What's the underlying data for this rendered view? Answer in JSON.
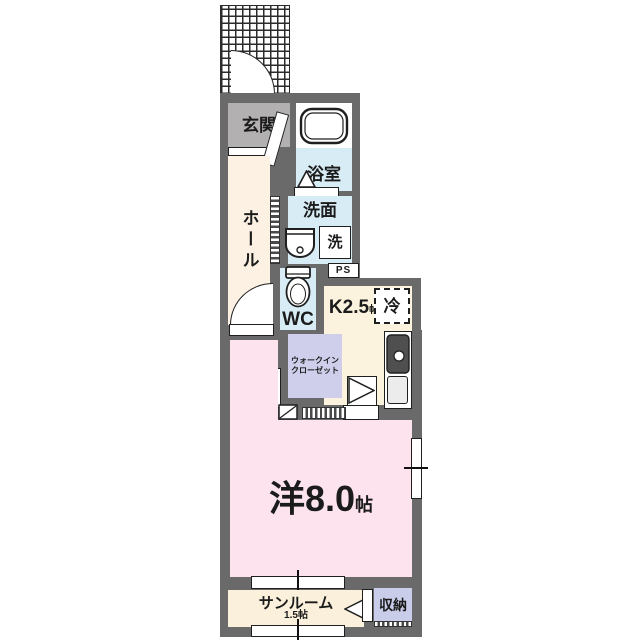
{
  "plan": {
    "rooms": {
      "genkan": "玄関",
      "bathroom": "浴室",
      "hall": "ホール",
      "washroom": "洗面",
      "washer": "洗",
      "ps": "PS",
      "wc": "WC",
      "kitchen": {
        "name": "K2.5",
        "unit": "帖"
      },
      "fridge": "冷",
      "wic": {
        "line1": "ウォークイン",
        "line2": "クローゼット"
      },
      "main": {
        "name": "洋8.0",
        "unit": "帖"
      },
      "sunroom": {
        "name": "サンルーム",
        "size": "1.5帖"
      },
      "storage": "収納"
    },
    "colors": {
      "wall": "#6a6a6a",
      "genkan_floor": "#b2b0b0",
      "hall_floor": "#fdf1e3",
      "wet_rooms": "#d7ecf5",
      "kitchen_floor": "#fbf3dd",
      "closet": "#cfcfeb",
      "main_room": "#fce3ee",
      "sunroom_floor": "#faf0db",
      "storage_fill": "#c9cde9"
    }
  }
}
